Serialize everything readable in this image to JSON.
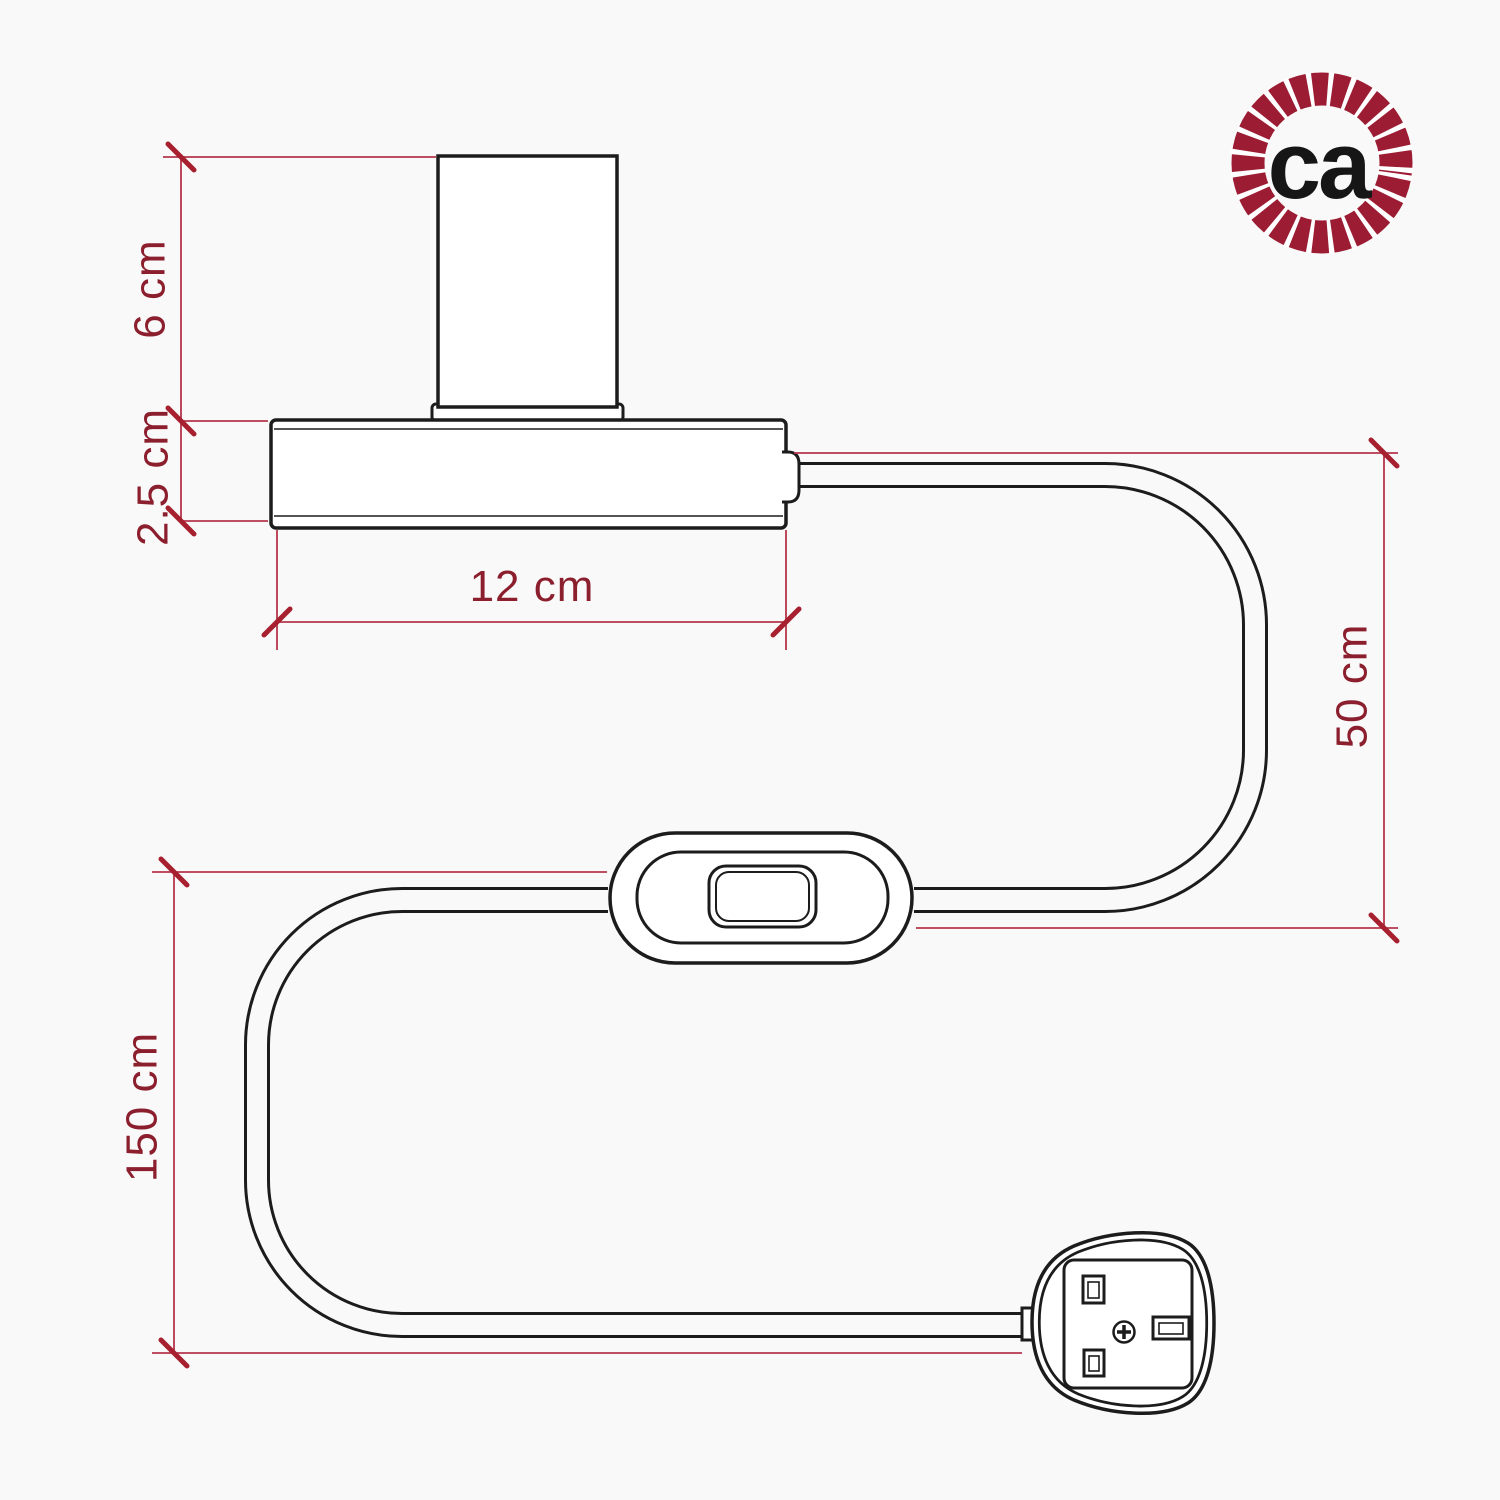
{
  "diagram": {
    "type": "product-dimension-drawing",
    "background": "#faf9f9",
    "line_color": "#1c1c1c",
    "dim_line_color": "#b5354b",
    "tick_color": "#a6202f",
    "label_color": "#8c1f2e",
    "labels": {
      "lamp_holder_height": "6 cm",
      "base_height": "2.5 cm",
      "base_width": "12 cm",
      "base_to_switch": "50 cm",
      "switch_to_plug": "150 cm"
    },
    "components": [
      "lamp holder",
      "lamp base",
      "power cable",
      "inline switch",
      "UK plug"
    ]
  },
  "logo": {
    "text": "ca",
    "ring_color": "#9c1c33",
    "text_color": "#161616"
  }
}
